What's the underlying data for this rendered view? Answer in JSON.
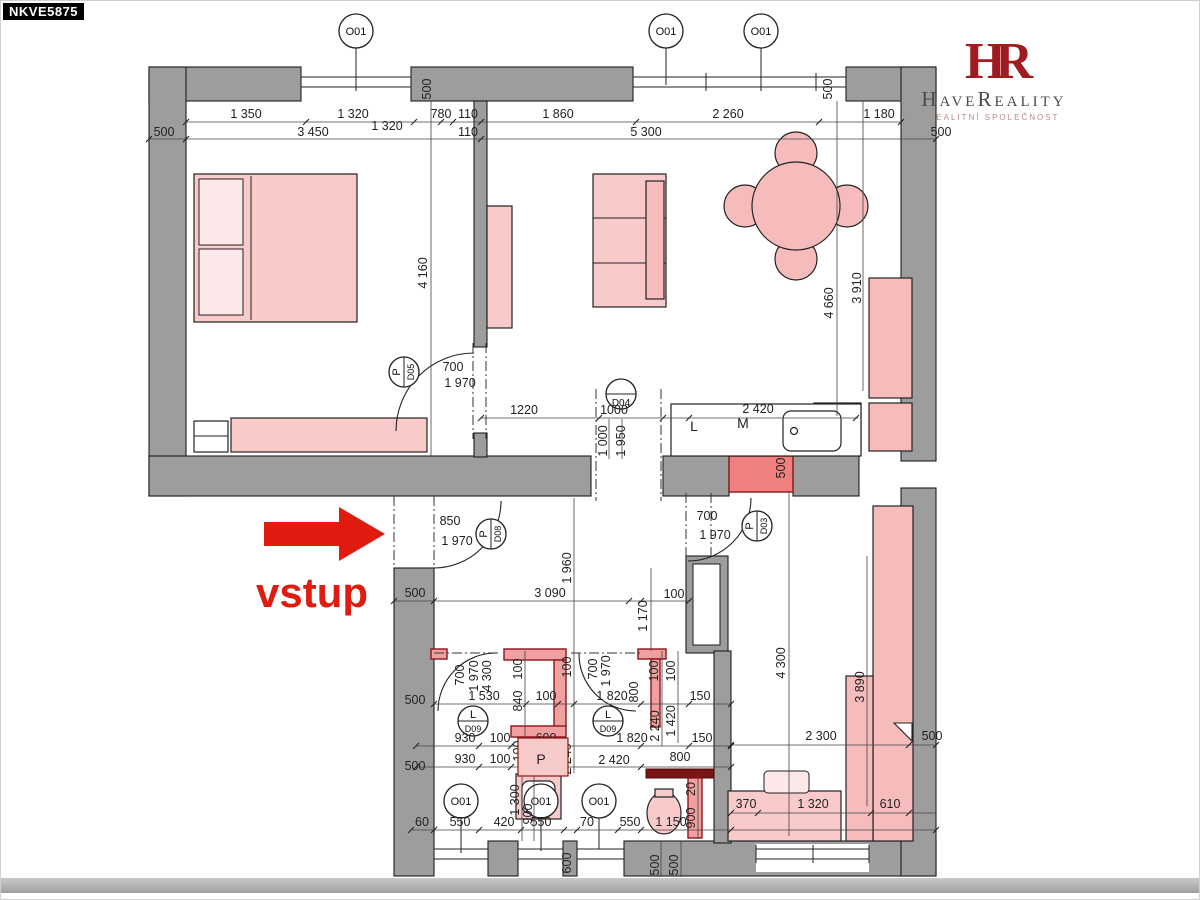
{
  "page": {
    "code": "NKVE5875",
    "entrance_label": "vstup"
  },
  "logo": {
    "monogram": "HR",
    "name": "HaveReality",
    "subtitle": "REALITNÍ SPOLEČNOST"
  },
  "colors": {
    "accent_red": "#e01b10",
    "logo_red": "#a01a20",
    "wall_gray": "#9d9d9d",
    "furniture_pink": "#f9caca",
    "partition_pink": "#f0a0a0",
    "dark_red_wall": "#7a1416"
  },
  "markers": {
    "windows_top": [
      "O01",
      "O01",
      "O01"
    ],
    "windows_bottom": [
      "O01",
      "O01",
      "O01"
    ],
    "doors": {
      "d05": {
        "swing": "P",
        "id": "D05"
      },
      "d04": {
        "id": "D04"
      },
      "d08": {
        "swing": "P",
        "id": "D08"
      },
      "d03": {
        "swing": "P",
        "id": "D03"
      },
      "d09a": {
        "swing": "L",
        "id": "D09"
      },
      "d09b": {
        "swing": "L",
        "id": "D09"
      }
    }
  },
  "kitchen": {
    "left_unit": "L",
    "middle_unit": "M",
    "shaft": "P"
  },
  "dims": {
    "top1": [
      "1 350",
      "1 320",
      "780",
      "110",
      "1 860",
      "2 260",
      "1 180"
    ],
    "top2": [
      "500",
      "3 450",
      "1 320",
      "110",
      "5 300",
      "500"
    ],
    "vert_top": [
      "500",
      "500"
    ],
    "vert_upper": [
      "4 160",
      "4 660",
      "3 910"
    ],
    "d05": [
      "700",
      "1 970"
    ],
    "kitchen_row": [
      "1220",
      "1000",
      "2 420"
    ],
    "kitchen_vert": [
      "1 000",
      "1 950",
      "500"
    ],
    "d08": [
      "850",
      "1 970"
    ],
    "d03": [
      "700",
      "1 970"
    ],
    "hall": [
      "3 090",
      "100"
    ],
    "hall_vert": [
      "1 960",
      "1 170"
    ],
    "left_wall": [
      "500",
      "500",
      "500"
    ],
    "bathL_rot": [
      "700",
      "1 970",
      "4 300",
      "100",
      "840",
      "100",
      "2 240",
      "100"
    ],
    "bathL_rows": [
      "1 530",
      "100",
      "930",
      "100",
      "600",
      "930",
      "100"
    ],
    "bathR_rot": [
      "700",
      "1 970",
      "800",
      "100",
      "100",
      "2 240",
      "1 420"
    ],
    "bathR_rows": [
      "1 820",
      "150",
      "1 820",
      "150",
      "2 420",
      "800"
    ],
    "wc_vert": [
      "20",
      "900"
    ],
    "bottom_row": [
      "60",
      "550",
      "420",
      "550",
      "70",
      "550",
      "1 150"
    ],
    "bottom_vert": [
      "1 300",
      "900",
      "600",
      "500",
      "500"
    ],
    "lower_right_vert": [
      "4 300",
      "3 890"
    ],
    "lower_right_rows": [
      "2 300",
      "500",
      "370",
      "1 320",
      "610"
    ]
  }
}
